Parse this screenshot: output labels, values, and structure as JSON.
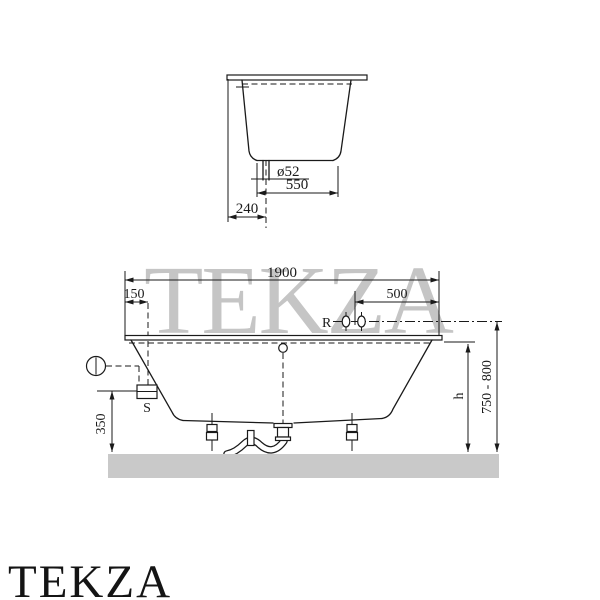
{
  "watermark_text": "TEKZA",
  "brand_logo": "TEKZA",
  "front_view": {
    "overall_length": "1900",
    "overflow_offset": "150",
    "faucet_offset": "500",
    "faucet_label": "R",
    "overflow_unit_label": "S",
    "overflow_height": "350",
    "rim_height_label": "h",
    "faucet_height_range": "750 - 800"
  },
  "end_view": {
    "edge_to_drain": "240",
    "drain_diameter": "ø52",
    "bottom_width": "550"
  }
}
